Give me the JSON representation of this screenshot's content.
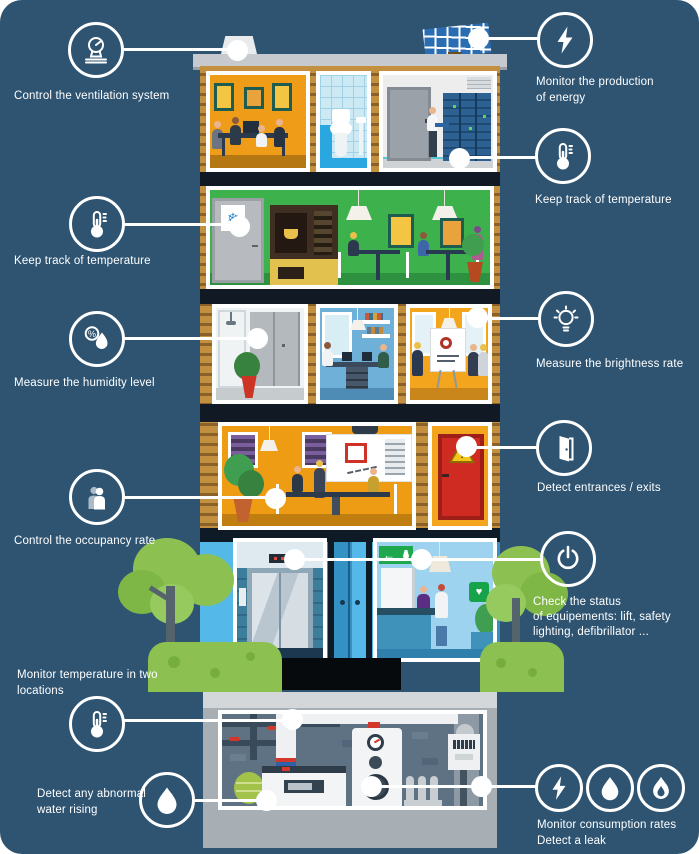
{
  "theme": {
    "background": "#2e5472",
    "accent": "#ffffff",
    "wood": "#c2903e",
    "kitchen_green": "#3db24c",
    "office_orange": "#ef9c18",
    "glass_blue": "#3f9fd4",
    "door_red": "#cf2b23",
    "tree_green": "#8cc152",
    "basement_gray": "#a7aeb4"
  },
  "signs": {
    "snowflake": "❄",
    "exit_arrow": "←",
    "defib_heart": "♥",
    "warning_mark": "!",
    "percent": "%"
  },
  "callouts": {
    "ventilation": {
      "icon": "ventilation-gauge-icon",
      "line1": "Control the ventilation system"
    },
    "energy": {
      "icon": "lightning-icon",
      "line1": "Monitor the production",
      "line2": "of energy"
    },
    "temp_top": {
      "icon": "thermometer-icon",
      "line1": "Keep track of temperature"
    },
    "temp_kitchen": {
      "icon": "thermometer-icon",
      "line1": "Keep track of temperature"
    },
    "humidity": {
      "icon": "humidity-percent-drop-icon",
      "line1": "Measure the humidity level"
    },
    "brightness": {
      "icon": "light-bulb-icon",
      "line1": "Measure the brightness rate"
    },
    "entrances": {
      "icon": "open-door-icon",
      "line1": "Detect entrances / exits"
    },
    "occupancy": {
      "icon": "people-icon",
      "line1": "Control the occupancy rate"
    },
    "equipment": {
      "icon": "power-icon",
      "line1": "Check the status",
      "line2": "of equipements: lift, safety",
      "line3": "lighting, defibrillator ..."
    },
    "two_locations": {
      "icon": "thermometer-icon",
      "line1": "Monitor temperature in two",
      "line2": "locations"
    },
    "water": {
      "icon": "water-drop-icon",
      "line1": "Detect any abnormal",
      "line2": "water rising"
    },
    "consumption": {
      "icons": [
        "lightning-icon",
        "water-drop-icon",
        "flame-icon"
      ],
      "line1": "Monitor consumption rates",
      "line2": "Detect a leak"
    }
  }
}
